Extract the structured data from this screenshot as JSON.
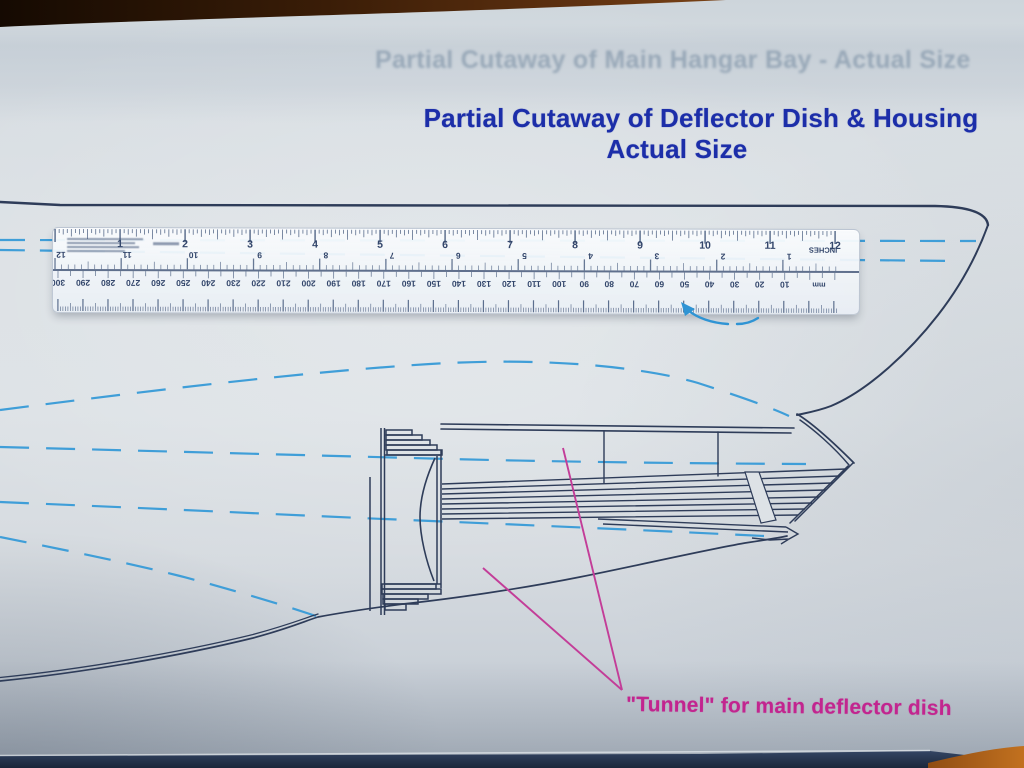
{
  "ghost_title": {
    "text": "Partial Cutaway of Main Hangar Bay - Actual Size"
  },
  "title": {
    "line1": "Partial Cutaway of Deflector Dish & Housing",
    "line2": "Actual Size"
  },
  "caption": {
    "text": "\"Tunnel\" for main deflector dish"
  },
  "ruler": {
    "inch_numbers": [
      "1",
      "2",
      "3",
      "4",
      "5",
      "6",
      "7",
      "8",
      "9",
      "10",
      "11",
      "12"
    ],
    "reverse_inch_numbers": [
      "12",
      "11",
      "10",
      "9",
      "8",
      "7",
      "6",
      "5",
      "4",
      "3",
      "2",
      "1"
    ],
    "mm_numbers": [
      "300",
      "290",
      "280",
      "270",
      "260",
      "250",
      "240",
      "230",
      "220",
      "210",
      "200",
      "190",
      "180",
      "170",
      "160",
      "150",
      "140",
      "130",
      "120",
      "110",
      "100",
      "90",
      "80",
      "70",
      "60",
      "50",
      "40",
      "30",
      "20",
      "10"
    ],
    "inches_label": "INCHES",
    "mm_label": "mm"
  },
  "colors": {
    "ink": "#2e3c59",
    "dash_blue": "#3f9ed8",
    "pink": "#c2258f",
    "title_blue": "#1c2ea9",
    "paper": "#dce1e5",
    "wood_dark": "#3a1d07",
    "wood_orange": "#b06018"
  }
}
